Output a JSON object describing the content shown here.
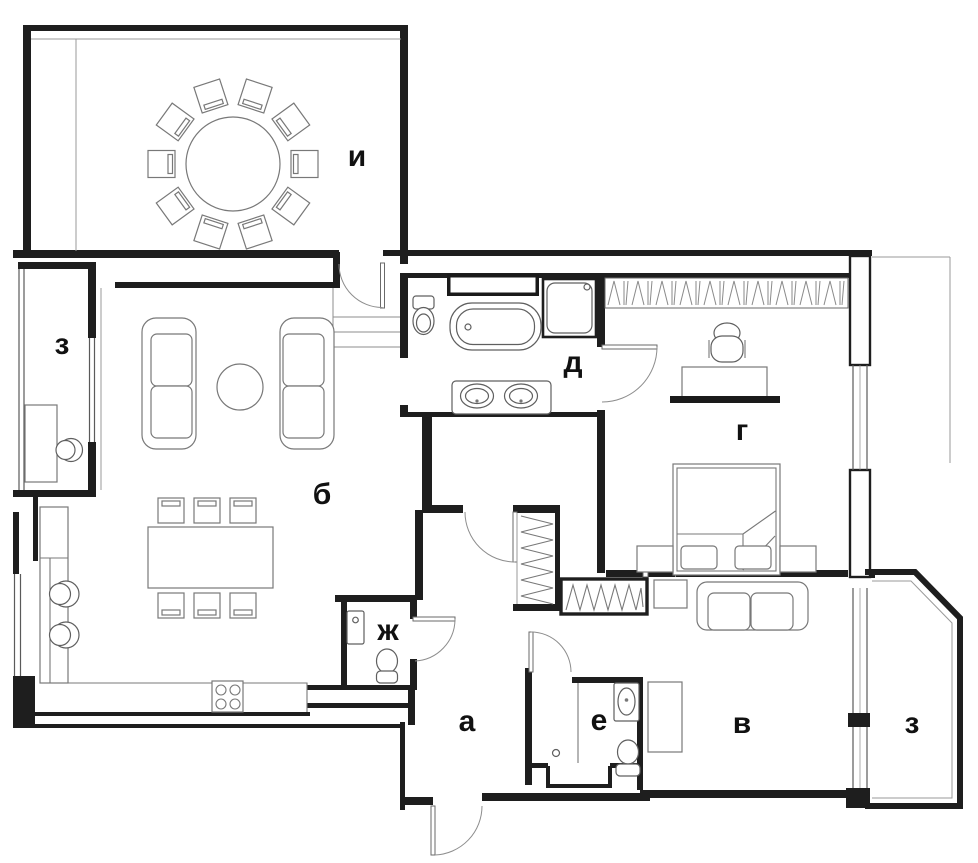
{
  "title": "apartment floor plan",
  "colors": {
    "background": "#ffffff",
    "wall": "#1e1e1e",
    "furniture_line": "#787878",
    "label": "#111111"
  },
  "rooms": [
    {
      "id": "terrace",
      "label": "и"
    },
    {
      "id": "balcony-left",
      "label": "з"
    },
    {
      "id": "living-room",
      "label": "б"
    },
    {
      "id": "bathroom-main",
      "label": "д"
    },
    {
      "id": "bedroom",
      "label": "г"
    },
    {
      "id": "wc",
      "label": "ж"
    },
    {
      "id": "hallway",
      "label": "а"
    },
    {
      "id": "shower-room",
      "label": "е"
    },
    {
      "id": "room-second",
      "label": "в"
    },
    {
      "id": "balcony-right",
      "label": "з"
    }
  ],
  "furniture": {
    "terrace": [
      "round-table",
      "chairs-x10"
    ],
    "balcony-left": [
      "desk",
      "stool"
    ],
    "living-room": [
      "sofa-left",
      "sofa-right",
      "round-coffee-table",
      "dining-table",
      "dining-chairs-x6",
      "kitchen-counter",
      "stove-4-burners",
      "bar-stools-x2"
    ],
    "bathroom-main": [
      "toilet",
      "cabinet",
      "bathtub",
      "shower-cabin",
      "double-sink-vanity"
    ],
    "bedroom": [
      "wardrobe-hangers",
      "office-chair",
      "desk",
      "console-shelf",
      "double-bed",
      "pillows-x2",
      "nightstands-x2"
    ],
    "wc": [
      "washbasin",
      "toilet"
    ],
    "hallway": [
      "closet-hangers",
      "entry-door"
    ],
    "shower-room": [
      "shower-area",
      "washbasin",
      "toilet"
    ],
    "room-second": [
      "wardrobe-hangers",
      "side-table",
      "sofa",
      "desk"
    ],
    "balcony-right": []
  }
}
